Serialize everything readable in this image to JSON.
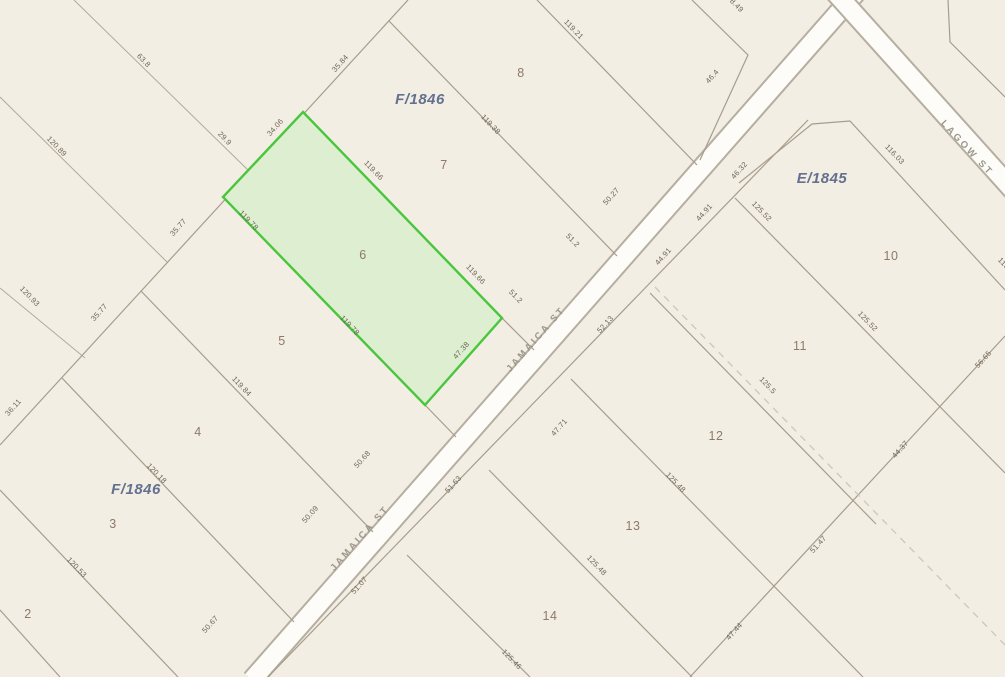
{
  "map": {
    "colors": {
      "background": "#f3eee3",
      "road_fill": "#fdfcf8",
      "road_casing": "#b5aea1",
      "parcel_line": "#a69d8c",
      "dashed_line": "#d0c9bb",
      "highlight_fill": "#ddefd0",
      "highlight_stroke": "#4ac63e",
      "dimension_text": "#6e6557",
      "lot_text": "#8d7a68",
      "block_text": "#63718f",
      "street_text": "#9d978b"
    },
    "highlighted_parcel": {
      "lot": "6",
      "block": "F/1846"
    },
    "streets": [
      {
        "name": "JAMAICA ST",
        "x": 538,
        "y": 341,
        "rot": -48.5
      },
      {
        "name": "JAMAICA ST",
        "x": 362,
        "y": 540,
        "rot": -48.5
      },
      {
        "name": "LAGOW ST",
        "x": 965,
        "y": 150,
        "rot": 47
      }
    ],
    "blocks": [
      {
        "name": "F/1846",
        "x": 420,
        "y": 104
      },
      {
        "name": "F/1846",
        "x": 136,
        "y": 494
      },
      {
        "name": "E/1845",
        "x": 822,
        "y": 183
      }
    ],
    "lots": [
      {
        "n": "2",
        "x": 28,
        "y": 618
      },
      {
        "n": "3",
        "x": 113,
        "y": 528
      },
      {
        "n": "4",
        "x": 198,
        "y": 436
      },
      {
        "n": "5",
        "x": 282,
        "y": 345
      },
      {
        "n": "6",
        "x": 363,
        "y": 259
      },
      {
        "n": "7",
        "x": 444,
        "y": 169
      },
      {
        "n": "8",
        "x": 521,
        "y": 77
      },
      {
        "n": "10",
        "x": 891,
        "y": 260
      },
      {
        "n": "11",
        "x": 800,
        "y": 350
      },
      {
        "n": "12",
        "x": 716,
        "y": 440
      },
      {
        "n": "13",
        "x": 633,
        "y": 530
      },
      {
        "n": "14",
        "x": 550,
        "y": 620
      }
    ],
    "dimensions": [
      {
        "v": "63.8",
        "x": 142,
        "y": 62,
        "r": 46
      },
      {
        "v": "29.9",
        "x": 223,
        "y": 140,
        "r": 46
      },
      {
        "v": "120.89",
        "x": 55,
        "y": 148,
        "r": 46
      },
      {
        "v": "120.93",
        "x": 28,
        "y": 298,
        "r": 46
      },
      {
        "v": "36.11",
        "x": 15,
        "y": 409,
        "r": -48
      },
      {
        "v": "35.77",
        "x": 101,
        "y": 314,
        "r": -48
      },
      {
        "v": "35.77",
        "x": 180,
        "y": 229,
        "r": -48
      },
      {
        "v": "34.06",
        "x": 277,
        "y": 129,
        "r": -48
      },
      {
        "v": "35.84",
        "x": 342,
        "y": 65,
        "r": -48
      },
      {
        "v": "119.21",
        "x": 572,
        "y": 31,
        "r": 46
      },
      {
        "v": "119.38",
        "x": 489,
        "y": 126,
        "r": 46
      },
      {
        "v": "119.66",
        "x": 372,
        "y": 172,
        "r": 46
      },
      {
        "v": "119.66",
        "x": 474,
        "y": 276,
        "r": 46
      },
      {
        "v": "119.78",
        "x": 247,
        "y": 222,
        "r": 46
      },
      {
        "v": "119.78",
        "x": 348,
        "y": 327,
        "r": 46
      },
      {
        "v": "119.84",
        "x": 240,
        "y": 388,
        "r": 46
      },
      {
        "v": "120.18",
        "x": 155,
        "y": 475,
        "r": 46
      },
      {
        "v": "120.53",
        "x": 75,
        "y": 569,
        "r": 46
      },
      {
        "v": "51.2",
        "x": 571,
        "y": 242,
        "r": 46
      },
      {
        "v": "51.2",
        "x": 514,
        "y": 298,
        "r": 46
      },
      {
        "v": "50.27",
        "x": 613,
        "y": 198,
        "r": -48
      },
      {
        "v": "47.38",
        "x": 463,
        "y": 352,
        "r": -48
      },
      {
        "v": "50.68",
        "x": 364,
        "y": 461,
        "r": -48
      },
      {
        "v": "50.09",
        "x": 312,
        "y": 516,
        "r": -48
      },
      {
        "v": "50.67",
        "x": 212,
        "y": 626,
        "r": -48
      },
      {
        "v": "46.4",
        "x": 714,
        "y": 78,
        "r": -48
      },
      {
        "v": "8.49",
        "x": 735,
        "y": 7,
        "r": 46
      },
      {
        "v": "116.03",
        "x": 893,
        "y": 156,
        "r": 46
      },
      {
        "v": "125.52",
        "x": 760,
        "y": 213,
        "r": 46
      },
      {
        "v": "125.52",
        "x": 866,
        "y": 323,
        "r": 46
      },
      {
        "v": "125.5",
        "x": 766,
        "y": 387,
        "r": 46
      },
      {
        "v": "125.48",
        "x": 674,
        "y": 484,
        "r": 46
      },
      {
        "v": "125.48",
        "x": 595,
        "y": 567,
        "r": 46
      },
      {
        "v": "125.46",
        "x": 510,
        "y": 661,
        "r": 46
      },
      {
        "v": "115",
        "x": 1002,
        "y": 265,
        "r": 46
      },
      {
        "v": "46.32",
        "x": 741,
        "y": 172,
        "r": -48
      },
      {
        "v": "44.91",
        "x": 706,
        "y": 214,
        "r": -48
      },
      {
        "v": "44.91",
        "x": 665,
        "y": 258,
        "r": -48
      },
      {
        "v": "52.13",
        "x": 607,
        "y": 326,
        "r": -48
      },
      {
        "v": "47.71",
        "x": 561,
        "y": 429,
        "r": -48
      },
      {
        "v": "51.63",
        "x": 455,
        "y": 486,
        "r": -48
      },
      {
        "v": "51.07",
        "x": 361,
        "y": 587,
        "r": -48
      },
      {
        "v": "56.65",
        "x": 985,
        "y": 361,
        "r": -48
      },
      {
        "v": "44.37",
        "x": 902,
        "y": 451,
        "r": -48
      },
      {
        "v": "51.47",
        "x": 820,
        "y": 546,
        "r": -48
      },
      {
        "v": "47.44",
        "x": 736,
        "y": 633,
        "r": -48
      }
    ]
  }
}
